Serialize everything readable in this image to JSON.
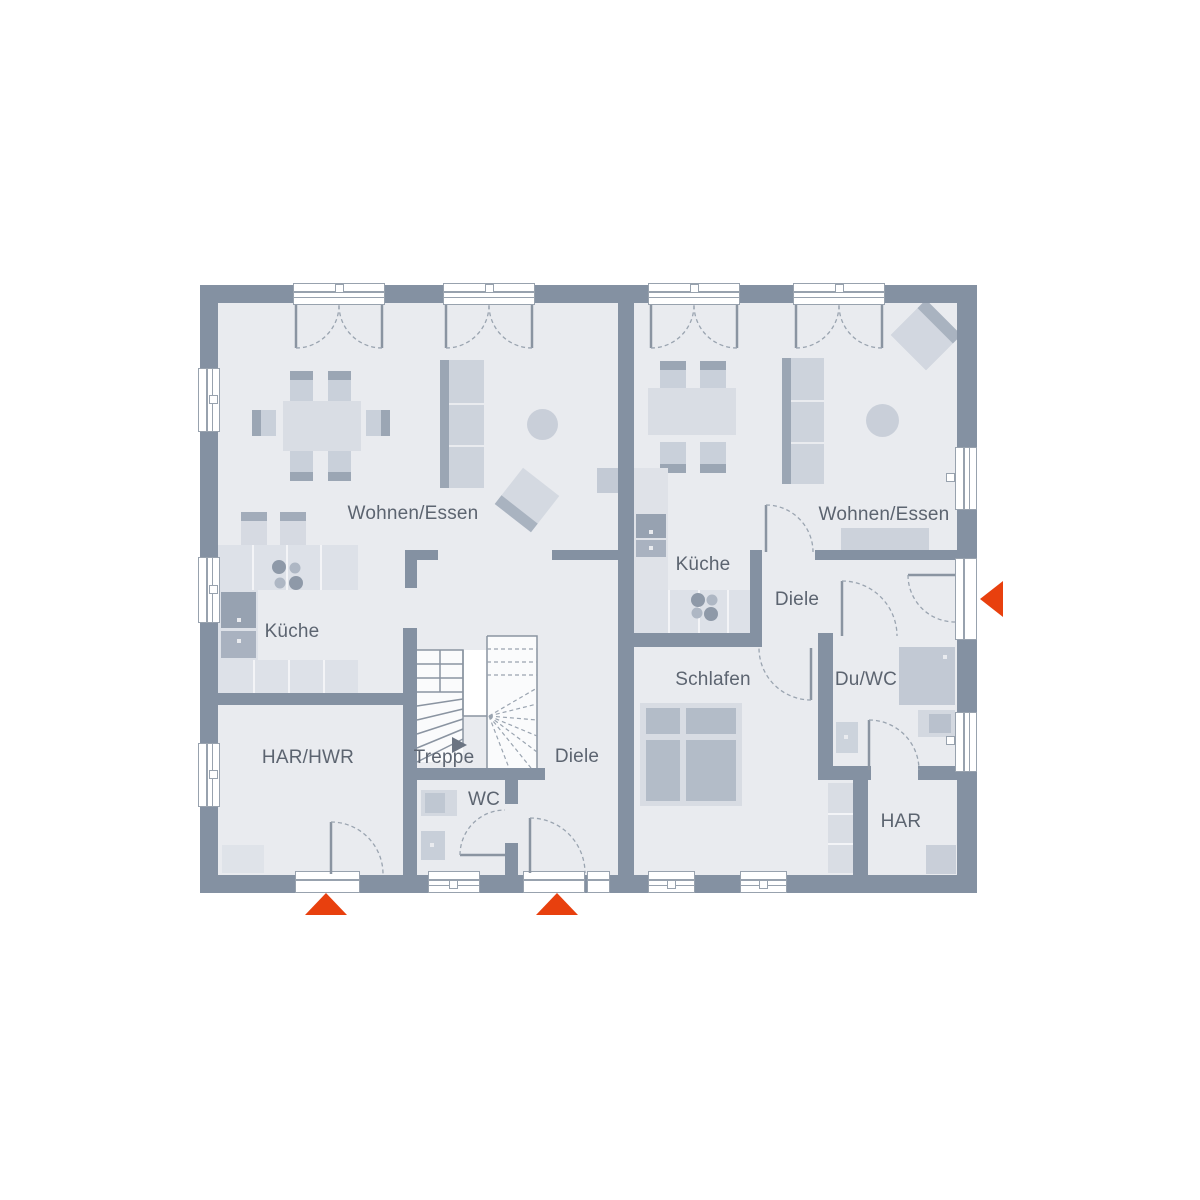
{
  "diagram": {
    "kind": "floor-plan",
    "units": [
      {
        "name": "left-unit",
        "rooms": [
          {
            "key": "wohnen_essen",
            "label": "Wohnen/Essen"
          },
          {
            "key": "kueche",
            "label": "Küche"
          },
          {
            "key": "har_hwr",
            "label": "HAR/HWR"
          },
          {
            "key": "treppe",
            "label": "Treppe"
          },
          {
            "key": "wc",
            "label": "WC"
          },
          {
            "key": "diele",
            "label": "Diele"
          }
        ]
      },
      {
        "name": "right-unit",
        "rooms": [
          {
            "key": "wohnen_essen",
            "label": "Wohnen/Essen"
          },
          {
            "key": "kueche",
            "label": "Küche"
          },
          {
            "key": "diele",
            "label": "Diele"
          },
          {
            "key": "schlafen",
            "label": "Schlafen"
          },
          {
            "key": "du_wc",
            "label": "Du/WC"
          },
          {
            "key": "har",
            "label": "HAR"
          }
        ]
      }
    ],
    "entrance_markers": [
      {
        "id": "left-unit-har-entrance",
        "direction": "up"
      },
      {
        "id": "left-unit-front-entrance",
        "direction": "up"
      },
      {
        "id": "right-unit-front-entrance",
        "direction": "left"
      }
    ],
    "colors": {
      "wall": "#8491A2",
      "floor": "#E9EBEF",
      "accent": "#E8400E",
      "furniture": "#CDD3DC"
    }
  }
}
